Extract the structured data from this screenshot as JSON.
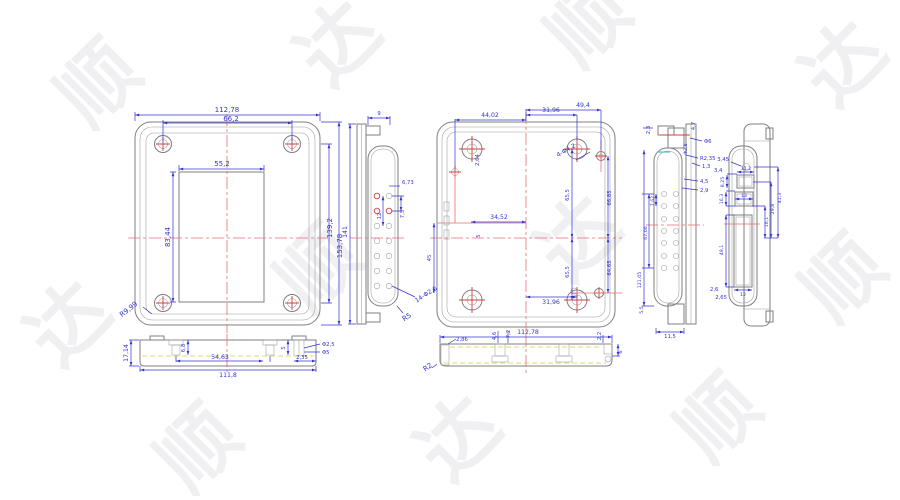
{
  "title": "enclosure-multiview-cad-drawing",
  "colors": {
    "dimension": "#3434d2",
    "outline": "#7f7f7f",
    "centerline": "#e86e6e",
    "screw_mark": "#cc4040",
    "hidden_line": "#cfcf5a",
    "watermark": "#f0f0f2"
  },
  "watermark": {
    "char1": "顺",
    "char2": "达"
  },
  "views": {
    "front": {
      "width": "112,78",
      "screw_span": "66,2",
      "window_width": "55,2",
      "window_height": "83,44",
      "screw_vspan": "139,2",
      "height": "153,78",
      "corner_radius": "R9,99"
    },
    "bottom_left": {
      "height": "17,14",
      "stud_h": "6,8",
      "boss_h": "5",
      "hole_d1": "Φ2,5",
      "hole_d2": "Φ5",
      "span_a": "54,63",
      "span_b": "111,8",
      "offset": "2,35"
    },
    "side_left": {
      "top": "9",
      "height": "141",
      "pitch_a": "6,73",
      "pitch_b": "12",
      "pitch_c": "7,5",
      "holes": "14-Φ2,6",
      "radius": "R5"
    },
    "back": {
      "dim_a": "44,02",
      "dim_b": "31,96",
      "dim_c": "49,4",
      "dim_d": "2,64",
      "holes": "4-Φ4,2",
      "dim_e": "34,52",
      "dim_f": "5",
      "dim_g": "45",
      "v1": "65,5",
      "v2": "65,5",
      "v3": "66,85",
      "v4": "64,65",
      "h_bot": "31,96"
    },
    "bottom_center": {
      "lip": "2,86",
      "width": "112,78",
      "radius": "R2",
      "stud_a": "4,6",
      "stud_b": "7,2",
      "step_a": "2,2",
      "step_b": "6"
    },
    "side_right": {
      "t1": "2,3",
      "t2": "4,7",
      "t3": "Φ6",
      "t4": "Φ2,8",
      "t5": "R2,35",
      "t6": "1,3",
      "t7": "4,5",
      "t8": "2,9",
      "v1": "7,62",
      "v2": "67,06",
      "v3": "121,05",
      "b1": "5,5",
      "b2": "11,5",
      "f1": "3,4",
      "f2": "2,6"
    },
    "end_right": {
      "a": "3,45",
      "b": "11,2",
      "c": "8,25",
      "d": "16,3",
      "e": "13",
      "f": "41,3",
      "g": "29,8",
      "h": "16,1",
      "i": "49,1",
      "j": "12",
      "k": "2,65"
    }
  }
}
